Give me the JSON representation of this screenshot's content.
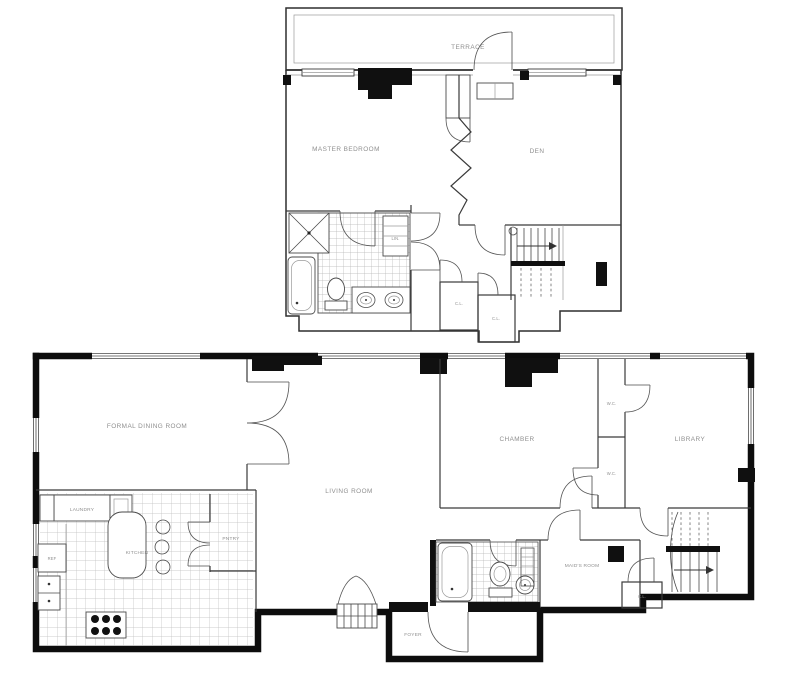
{
  "page": {
    "background": "#ffffff",
    "wall_ink": "#0d0d0d",
    "line_ink": "#3a3a3a",
    "label_color": "#8f8f8f"
  },
  "upper_floor": {
    "labels": {
      "terrace": "TERRACE",
      "master_bedroom": "MASTER BEDROOM",
      "den": "DEN",
      "linen": "LIN.",
      "closet_a": "C.L.",
      "closet_b": "C.L."
    }
  },
  "lower_floor": {
    "labels": {
      "formal_dining_room": "FORMAL DINING ROOM",
      "living_room": "LIVING ROOM",
      "chamber": "CHAMBER",
      "library": "LIBRARY",
      "kitchen": "KITCHEN",
      "laundry": "LAUNDRY",
      "pantry": "PNTRY",
      "refrigerator": "REF",
      "maids_room": "MAID'S ROOM",
      "foyer": "FOYER",
      "wc_a": "W.C.",
      "wc_b": "W.C.",
      "closet_a": "C.L."
    }
  }
}
